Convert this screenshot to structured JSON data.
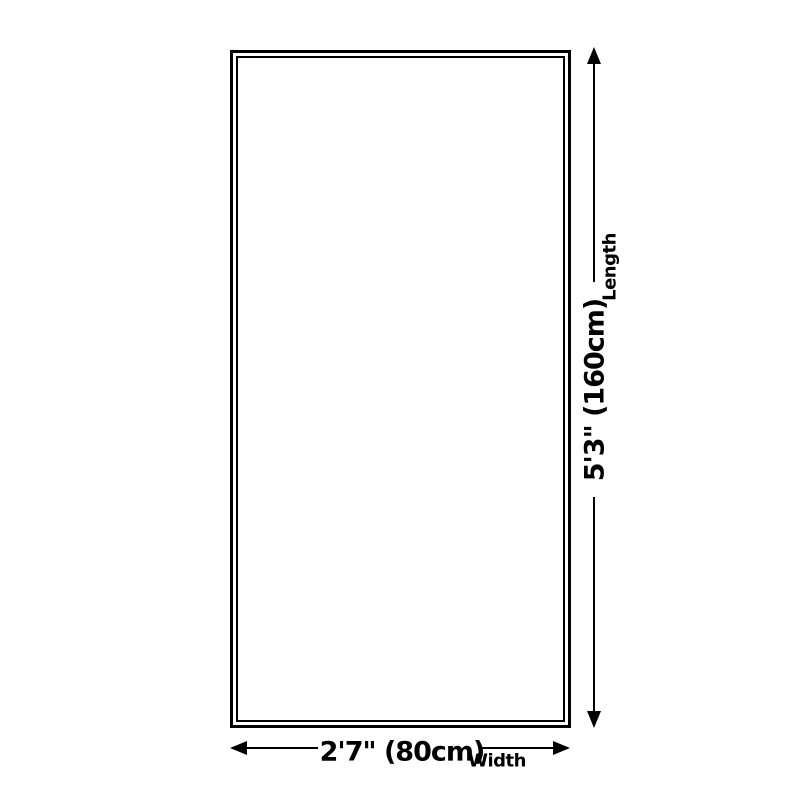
{
  "diagram": {
    "kind": "product-size-diagram",
    "background_color": "#ffffff",
    "line_color": "#000000"
  },
  "dimensions": {
    "length": {
      "value": "5'3\" (160cm)",
      "axis_label": "Length"
    },
    "width": {
      "value": "2'7\" (80cm)",
      "axis_label": "Width"
    }
  },
  "icons": {
    "vertical_arrow_top": "arrow-up-icon",
    "vertical_arrow_bottom": "arrow-down-icon",
    "horizontal_arrow_left": "arrow-left-icon",
    "horizontal_arrow_right": "arrow-right-icon"
  }
}
